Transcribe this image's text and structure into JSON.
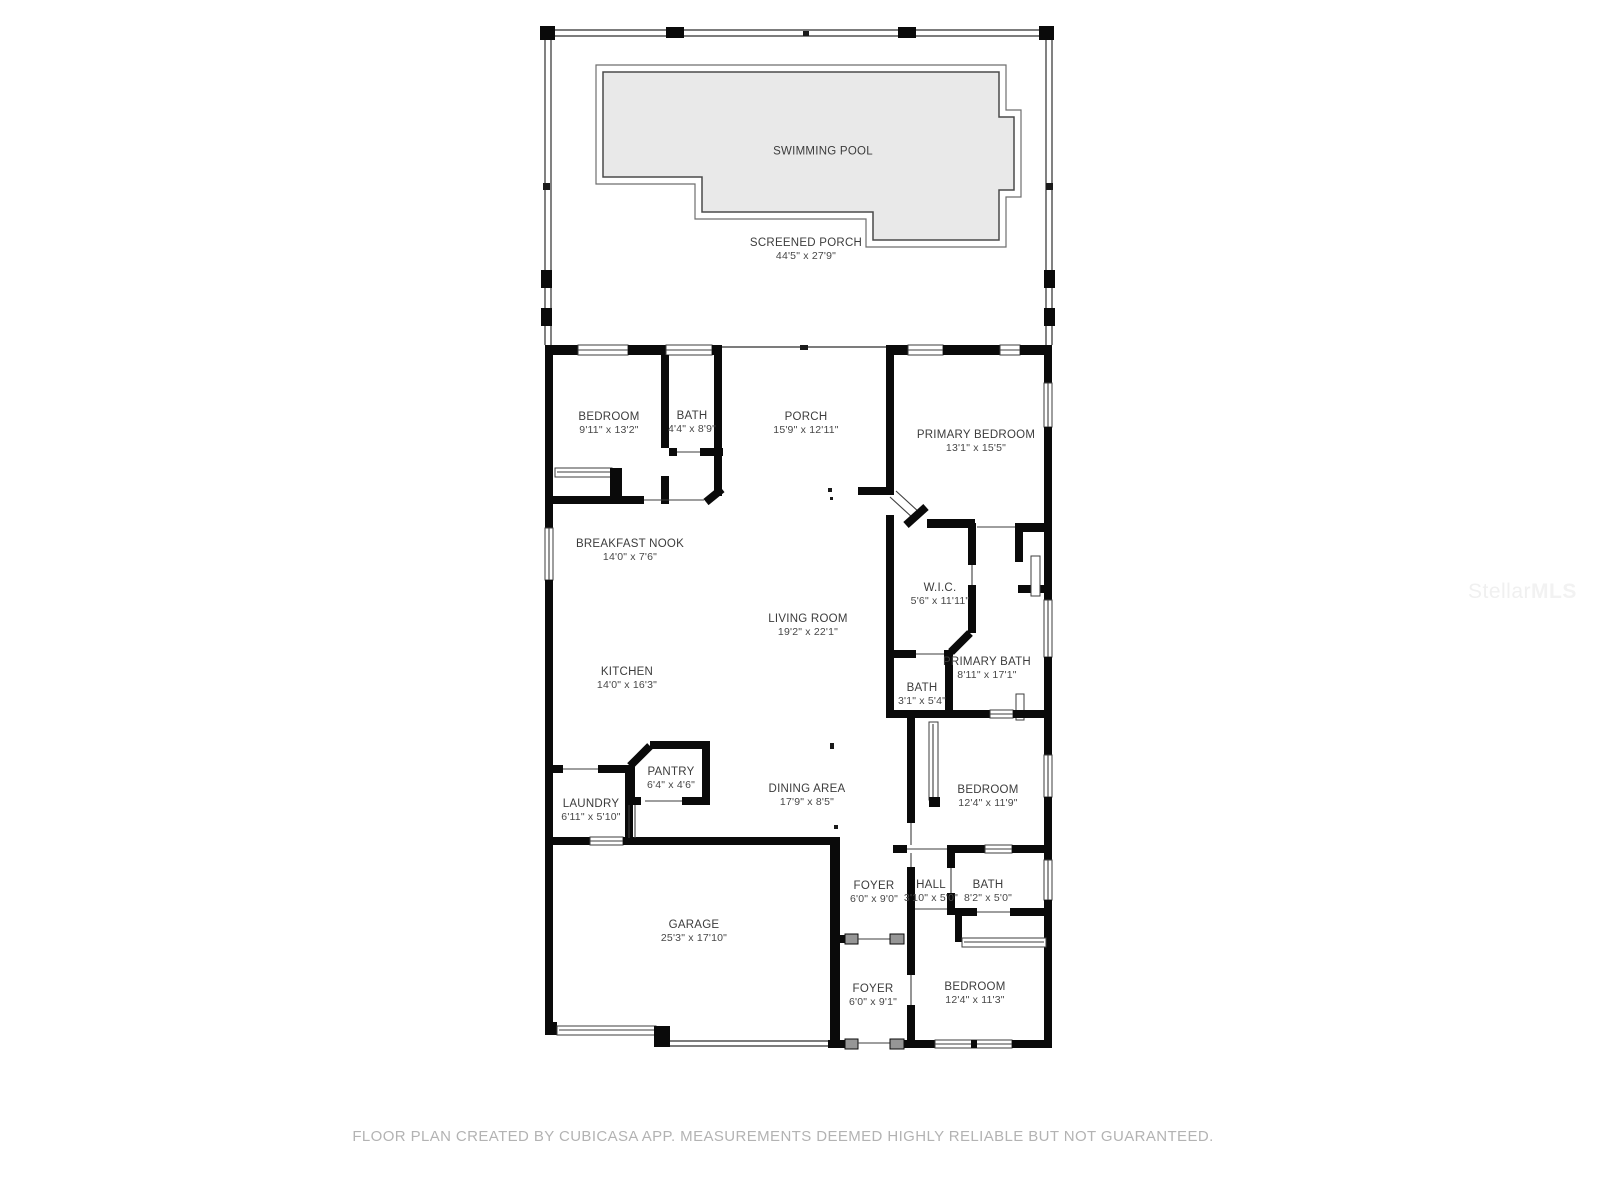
{
  "footer": {
    "text": "FLOOR PLAN CREATED BY CUBICASA APP. MEASUREMENTS DEEMED HIGHLY RELIABLE BUT NOT GUARANTEED."
  },
  "watermark": {
    "brand_first": "Stellar",
    "brand_second": "MLS"
  },
  "colors": {
    "wall": "#0a0a0a",
    "pool_fill": "#e9e9e9",
    "pool_border": "#4a4a4a",
    "label_text": "#3c3c3c",
    "footer_text": "#b3b3b3",
    "watermark_text": "#f0f0f0",
    "background": "#ffffff"
  },
  "floor_plan": {
    "creator": "CUBICASA APP",
    "rooms": [
      {
        "id": "swimming-pool",
        "name": "SWIMMING POOL",
        "dimensions": ""
      },
      {
        "id": "screened-porch",
        "name": "SCREENED PORCH",
        "dimensions": "44'5\" x 27'9\""
      },
      {
        "id": "bedroom-1",
        "name": "BEDROOM",
        "dimensions": "9'11\" x 13'2\""
      },
      {
        "id": "bath-1",
        "name": "BATH",
        "dimensions": "4'4\" x 8'9\""
      },
      {
        "id": "porch",
        "name": "PORCH",
        "dimensions": "15'9\" x 12'11\""
      },
      {
        "id": "primary-bedroom",
        "name": "PRIMARY BEDROOM",
        "dimensions": "13'1\" x 15'5\""
      },
      {
        "id": "breakfast-nook",
        "name": "BREAKFAST NOOK",
        "dimensions": "14'0\" x 7'6\""
      },
      {
        "id": "living-room",
        "name": "LIVING ROOM",
        "dimensions": "19'2\" x 22'1\""
      },
      {
        "id": "wic",
        "name": "W.I.C.",
        "dimensions": "5'6\" x 11'11\""
      },
      {
        "id": "kitchen",
        "name": "KITCHEN",
        "dimensions": "14'0\" x 16'3\""
      },
      {
        "id": "primary-bath",
        "name": "PRIMARY BATH",
        "dimensions": "8'11\" x 17'1\""
      },
      {
        "id": "bath-2",
        "name": "BATH",
        "dimensions": "3'1\" x 5'4\""
      },
      {
        "id": "pantry",
        "name": "PANTRY",
        "dimensions": "6'4\" x 4'6\""
      },
      {
        "id": "dining-area",
        "name": "DINING AREA",
        "dimensions": "17'9\" x 8'5\""
      },
      {
        "id": "laundry",
        "name": "LAUNDRY",
        "dimensions": "6'11\" x 5'10\""
      },
      {
        "id": "bedroom-2",
        "name": "BEDROOM",
        "dimensions": "12'4\" x 11'9\""
      },
      {
        "id": "foyer-1",
        "name": "FOYER",
        "dimensions": "6'0\" x 9'0\""
      },
      {
        "id": "hall",
        "name": "HALL",
        "dimensions": "3'10\" x 5'0\""
      },
      {
        "id": "bath-3",
        "name": "BATH",
        "dimensions": "8'2\" x 5'0\""
      },
      {
        "id": "garage",
        "name": "GARAGE",
        "dimensions": "25'3\" x 17'10\""
      },
      {
        "id": "foyer-2",
        "name": "FOYER",
        "dimensions": "6'0\" x 9'1\""
      },
      {
        "id": "bedroom-3",
        "name": "BEDROOM",
        "dimensions": "12'4\" x 11'3\""
      }
    ]
  }
}
